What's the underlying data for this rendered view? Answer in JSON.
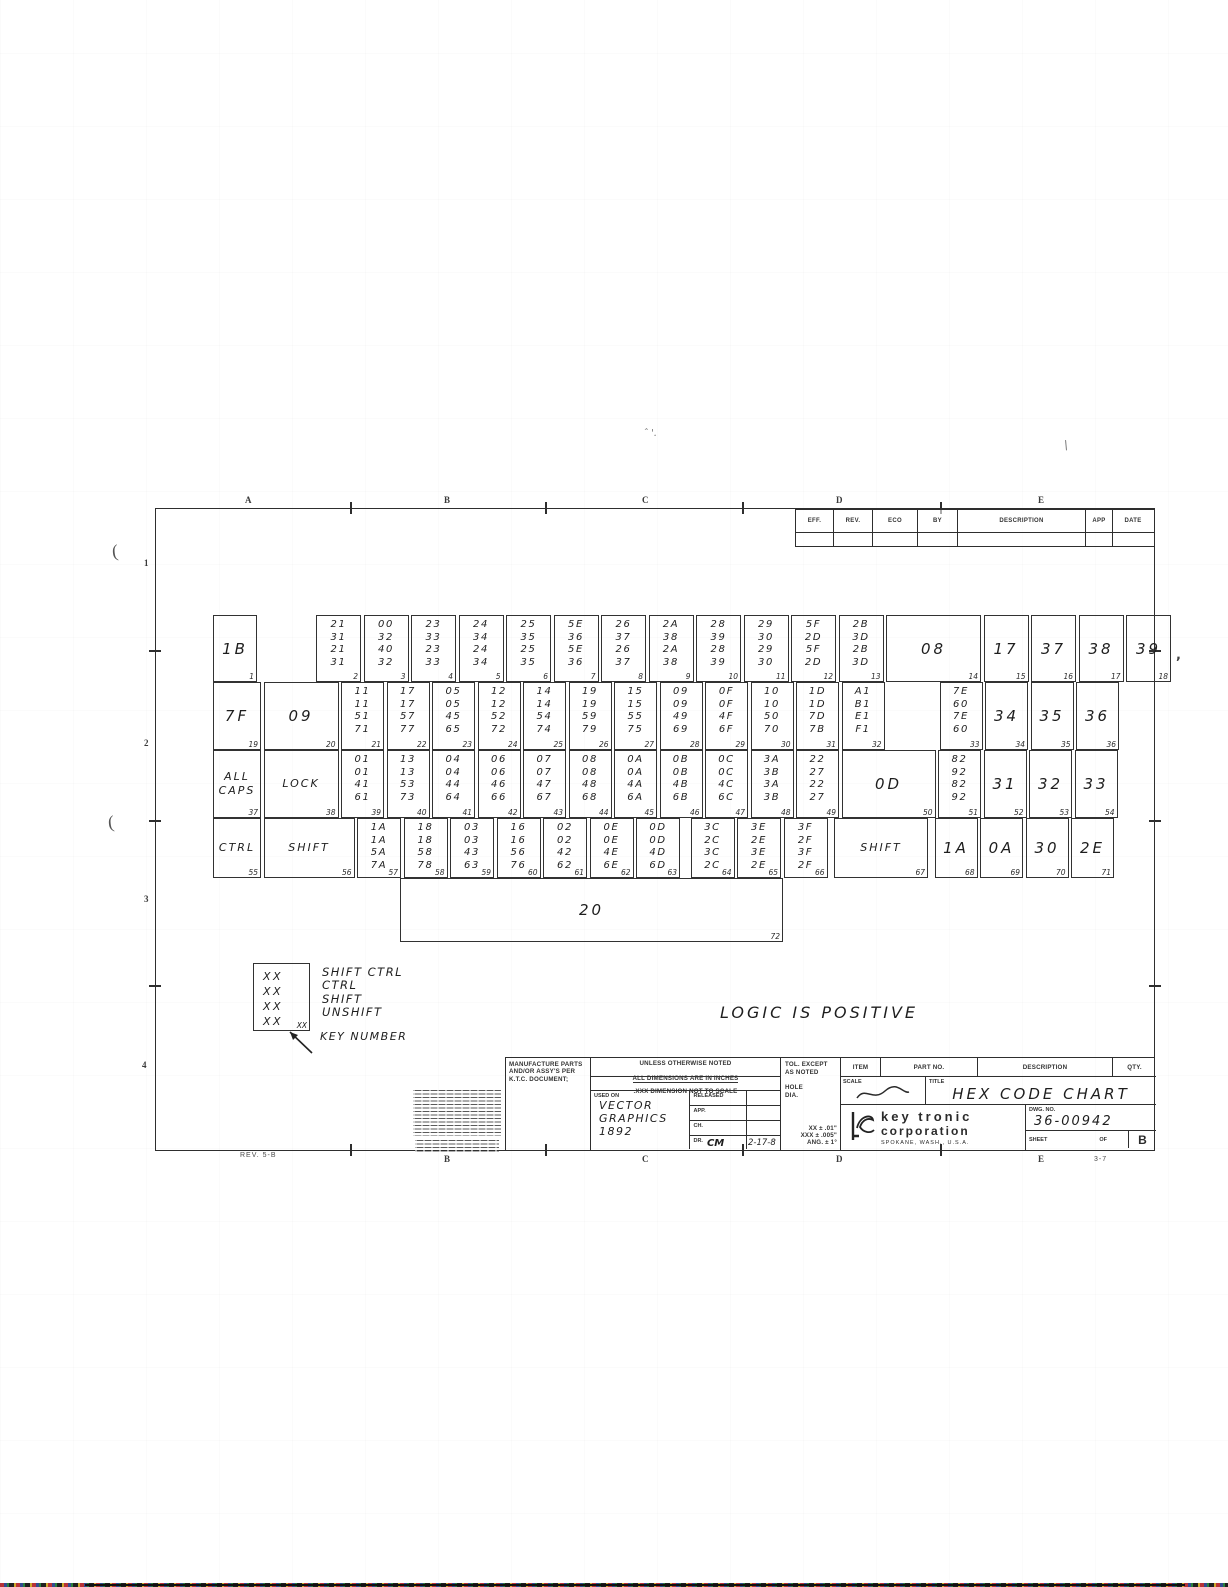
{
  "sheet": {
    "zones_top": [
      "A",
      "B",
      "C",
      "D",
      "E"
    ],
    "zones_bottom": [
      "B",
      "C",
      "D",
      "E"
    ],
    "zones_left": [
      "1",
      "2",
      "3",
      "4"
    ],
    "rev_note": "REV. 5-B",
    "page_note": "3-7"
  },
  "revision_table": {
    "headers": [
      "EFF.",
      "REV.",
      "ECO",
      "BY",
      "DESCRIPTION",
      "APP",
      "DATE"
    ]
  },
  "note": "LOGIC IS POSITIVE",
  "legend": {
    "placeholder": "XX",
    "key_number_placeholder": "XX",
    "lines": [
      "SHIFT CTRL",
      "CTRL",
      "SHIFT",
      "UNSHIFT"
    ],
    "arrow_label": "KEY NUMBER"
  },
  "artifacts": {
    "paren": "(",
    "caret": "ˆ '.",
    "backslash": "\\",
    "dot": ","
  },
  "keyboard": {
    "rows": [
      {
        "y": 615,
        "h": 67,
        "x0": 213,
        "cells": [
          {
            "code": "1B",
            "n": "1",
            "w": 44
          },
          {
            "gap": 54
          },
          {
            "codes": [
              "21",
              "31",
              "21",
              "31"
            ],
            "n": "2",
            "w": 45
          },
          {
            "codes": [
              "00",
              "32",
              "40",
              "32"
            ],
            "n": "3",
            "w": 45
          },
          {
            "codes": [
              "23",
              "33",
              "23",
              "33"
            ],
            "n": "4",
            "w": 45
          },
          {
            "codes": [
              "24",
              "34",
              "24",
              "34"
            ],
            "n": "5",
            "w": 45
          },
          {
            "codes": [
              "25",
              "35",
              "25",
              "35"
            ],
            "n": "6",
            "w": 45
          },
          {
            "codes": [
              "5E",
              "36",
              "5E",
              "36"
            ],
            "n": "7",
            "w": 45
          },
          {
            "codes": [
              "26",
              "37",
              "26",
              "37"
            ],
            "n": "8",
            "w": 45
          },
          {
            "codes": [
              "2A",
              "38",
              "2A",
              "38"
            ],
            "n": "9",
            "w": 45
          },
          {
            "codes": [
              "28",
              "39",
              "28",
              "39"
            ],
            "n": "10",
            "w": 45
          },
          {
            "codes": [
              "29",
              "30",
              "29",
              "30"
            ],
            "n": "11",
            "w": 45
          },
          {
            "codes": [
              "5F",
              "2D",
              "5F",
              "2D"
            ],
            "n": "12",
            "w": 45
          },
          {
            "codes": [
              "2B",
              "3D",
              "2B",
              "3D"
            ],
            "n": "13",
            "w": 45
          },
          {
            "code": "08",
            "n": "14",
            "w": 95
          },
          {
            "code": "17",
            "n": "15",
            "w": 45
          },
          {
            "code": "37",
            "n": "16",
            "w": 45
          },
          {
            "code": "38",
            "n": "17",
            "w": 45
          },
          {
            "code": "39",
            "n": "18",
            "w": 45
          }
        ]
      },
      {
        "y": 682,
        "h": 68,
        "x0": 213,
        "cells": [
          {
            "code": "7F",
            "n": "19",
            "w": 48
          },
          {
            "code": "09",
            "n": "20",
            "w": 75
          },
          {
            "codes": [
              "11",
              "11",
              "51",
              "71"
            ],
            "n": "21",
            "w": 43
          },
          {
            "codes": [
              "17",
              "17",
              "57",
              "77"
            ],
            "n": "22",
            "w": 43
          },
          {
            "codes": [
              "05",
              "05",
              "45",
              "65"
            ],
            "n": "23",
            "w": 43
          },
          {
            "codes": [
              "12",
              "12",
              "52",
              "72"
            ],
            "n": "24",
            "w": 43
          },
          {
            "codes": [
              "14",
              "14",
              "54",
              "74"
            ],
            "n": "25",
            "w": 43
          },
          {
            "codes": [
              "19",
              "19",
              "59",
              "79"
            ],
            "n": "26",
            "w": 43
          },
          {
            "codes": [
              "15",
              "15",
              "55",
              "75"
            ],
            "n": "27",
            "w": 43
          },
          {
            "codes": [
              "09",
              "09",
              "49",
              "69"
            ],
            "n": "28",
            "w": 43
          },
          {
            "codes": [
              "0F",
              "0F",
              "4F",
              "6F"
            ],
            "n": "29",
            "w": 43
          },
          {
            "codes": [
              "10",
              "10",
              "50",
              "70"
            ],
            "n": "30",
            "w": 43
          },
          {
            "codes": [
              "1D",
              "1D",
              "7D",
              "7B"
            ],
            "n": "31",
            "w": 43
          },
          {
            "codes": [
              "A1",
              "B1",
              "E1",
              "F1"
            ],
            "n": "32",
            "w": 43
          },
          {
            "gap": 50
          },
          {
            "codes": [
              "7E",
              "60",
              "7E",
              "60"
            ],
            "n": "33",
            "w": 43
          },
          {
            "code": "34",
            "n": "34",
            "w": 43
          },
          {
            "code": "35",
            "n": "35",
            "w": 43
          },
          {
            "code": "36",
            "n": "36",
            "w": 43
          }
        ]
      },
      {
        "y": 750,
        "h": 68,
        "x0": 213,
        "cells": [
          {
            "label": "ALL\nCAPS",
            "n": "37",
            "w": 48
          },
          {
            "label": "LOCK",
            "n": "38",
            "w": 75
          },
          {
            "codes": [
              "01",
              "01",
              "41",
              "61"
            ],
            "n": "39",
            "w": 43
          },
          {
            "codes": [
              "13",
              "13",
              "53",
              "73"
            ],
            "n": "40",
            "w": 43
          },
          {
            "codes": [
              "04",
              "04",
              "44",
              "64"
            ],
            "n": "41",
            "w": 43
          },
          {
            "codes": [
              "06",
              "06",
              "46",
              "66"
            ],
            "n": "42",
            "w": 43
          },
          {
            "codes": [
              "07",
              "07",
              "47",
              "67"
            ],
            "n": "43",
            "w": 43
          },
          {
            "codes": [
              "08",
              "08",
              "48",
              "68"
            ],
            "n": "44",
            "w": 43
          },
          {
            "codes": [
              "0A",
              "0A",
              "4A",
              "6A"
            ],
            "n": "45",
            "w": 43
          },
          {
            "codes": [
              "0B",
              "0B",
              "4B",
              "6B"
            ],
            "n": "46",
            "w": 43
          },
          {
            "codes": [
              "0C",
              "0C",
              "4C",
              "6C"
            ],
            "n": "47",
            "w": 43
          },
          {
            "codes": [
              "3A",
              "3B",
              "3A",
              "3B"
            ],
            "n": "48",
            "w": 43
          },
          {
            "codes": [
              "22",
              "27",
              "22",
              "27"
            ],
            "n": "49",
            "w": 43
          },
          {
            "code": "0D",
            "n": "50",
            "w": 94
          },
          {
            "codes": [
              "82",
              "92",
              "82",
              "92"
            ],
            "n": "51",
            "w": 43
          },
          {
            "code": "31",
            "n": "52",
            "w": 43
          },
          {
            "code": "32",
            "n": "53",
            "w": 43
          },
          {
            "code": "33",
            "n": "54",
            "w": 43
          }
        ]
      },
      {
        "y": 818,
        "h": 60,
        "x0": 213,
        "cells": [
          {
            "label": "CTRL",
            "n": "55",
            "w": 48
          },
          {
            "label": "SHIFT",
            "n": "56",
            "w": 91
          },
          {
            "codes": [
              "1A",
              "1A",
              "5A",
              "7A"
            ],
            "n": "57",
            "w": 44
          },
          {
            "codes": [
              "18",
              "18",
              "58",
              "78"
            ],
            "n": "58",
            "w": 44
          },
          {
            "codes": [
              "03",
              "03",
              "43",
              "63"
            ],
            "n": "59",
            "w": 44
          },
          {
            "codes": [
              "16",
              "16",
              "56",
              "76"
            ],
            "n": "60",
            "w": 44
          },
          {
            "codes": [
              "02",
              "02",
              "42",
              "62"
            ],
            "n": "61",
            "w": 44
          },
          {
            "codes": [
              "0E",
              "0E",
              "4E",
              "6E"
            ],
            "n": "62",
            "w": 44
          },
          {
            "codes": [
              "0D",
              "0D",
              "4D",
              "6D"
            ],
            "n": "63",
            "w": 44
          },
          {
            "codes": [
              "3C",
              "2C",
              "3C",
              "2C"
            ],
            "n": "64",
            "w": 44,
            "ml": 8
          },
          {
            "codes": [
              "3E",
              "2E",
              "3E",
              "2E"
            ],
            "n": "65",
            "w": 44
          },
          {
            "codes": [
              "3F",
              "2F",
              "3F",
              "2F"
            ],
            "n": "66",
            "w": 44
          },
          {
            "label": "SHIFT",
            "n": "67",
            "w": 94,
            "ml": 4
          },
          {
            "code": "1A",
            "n": "68",
            "w": 43,
            "ml": 4
          },
          {
            "code": "0A",
            "n": "69",
            "w": 43
          },
          {
            "code": "30",
            "n": "70",
            "w": 43
          },
          {
            "code": "2E",
            "n": "71",
            "w": 43
          }
        ]
      },
      {
        "y": 878,
        "h": 64,
        "x0": 400,
        "cells": [
          {
            "code": "20",
            "n": "72",
            "w": 383
          }
        ]
      }
    ]
  },
  "title_block": {
    "manufacture_note": "MANUFACTURE PARTS AND/OR ASSY'S PER K.T.C. DOCUMENT;",
    "dims_note_1": "UNLESS OTHERWISE NOTED",
    "dims_note_2": "ALL DIMENSIONS ARE IN INCHES",
    "dims_note_3": ".XXX    DIMENSION NOT TO SCALE",
    "used_on_label": "USED ON",
    "used_on_value": "VECTOR\nGRAPHICS\n1892",
    "released_label": "RELEASED",
    "app_label": "APP.",
    "ch_label": "CH.",
    "dr_label": "DR.",
    "dr_value": "CM",
    "dr_date": "2-17-8",
    "tol_label": "TOL. EXCEPT\nAS NOTED",
    "hole_label": "HOLE\nDIA.",
    "tol_xx": "XX ±   .01\"",
    "tol_xxx": "XXX ± .005\"",
    "tol_ang": "ANG. ±     1°",
    "item_label": "ITEM",
    "part_no_label": "PART NO.",
    "description_label": "DESCRIPTION",
    "qty_label": "QTY.",
    "scale_label": "SCALE",
    "title_label": "TITLE",
    "title_value": "HEX CODE CHART",
    "company_line1": "key tronic",
    "company_line2": "corporation",
    "company_line3": "SPOKANE, WASH., U.S.A.",
    "dwg_no_label": "DWG. NO.",
    "dwg_no_value": "36-00942",
    "sheet_label": "SHEET",
    "of_label": "OF",
    "rev_letter": "B"
  }
}
